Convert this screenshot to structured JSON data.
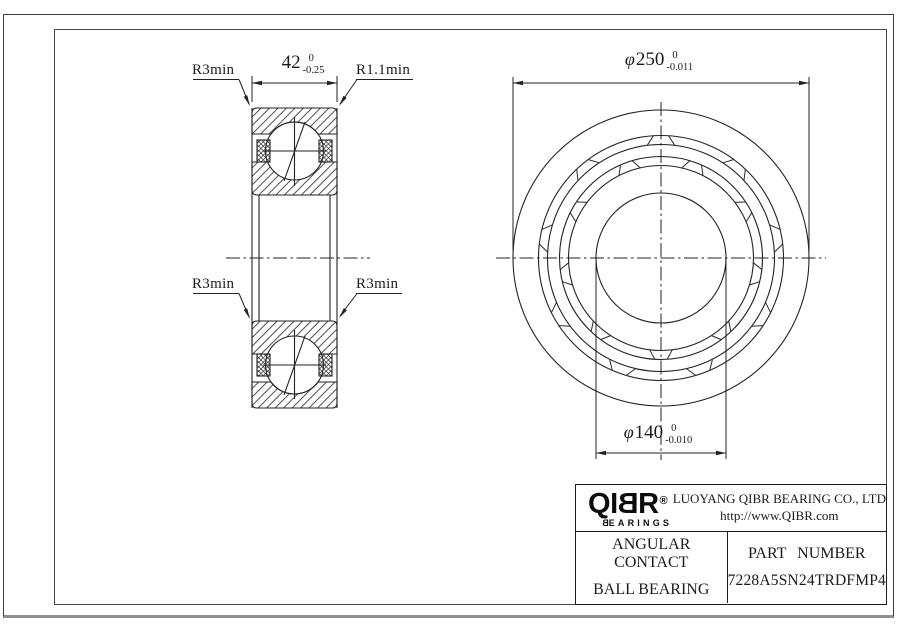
{
  "section_view": {
    "label_top_left": "R3min",
    "label_top_right": "R1.1min",
    "label_bottom_left": "R3min",
    "label_bottom_right": "R3min",
    "width_dim": {
      "value": "42",
      "tol_upper": "0",
      "tol_lower": "-0.25"
    }
  },
  "front_view": {
    "outer_dia_dim": {
      "symbol": "φ",
      "value": "250",
      "tol_upper": "0",
      "tol_lower": "-0.011"
    },
    "bore_dia_dim": {
      "symbol": "φ",
      "value": "140",
      "tol_upper": "0",
      "tol_lower": "-0.010"
    }
  },
  "title_block": {
    "logo": {
      "l1": "Q",
      "l2": "I",
      "l3": "B",
      "l4": "R",
      "registered": "®",
      "sub_first": "B",
      "sub_rest": "EARINGS"
    },
    "company": "LUOYANG QIBR BEARING CO., LTD",
    "website": "http://www.QIBR.com",
    "product_line1": "ANGULAR CONTACT",
    "product_line2": "BALL BEARING",
    "part_label": "PART NUMBER",
    "part_number": "7228A5SN24TRDFMP4"
  },
  "colors": {
    "line": "#222222",
    "logo": "#0c0c0c"
  }
}
